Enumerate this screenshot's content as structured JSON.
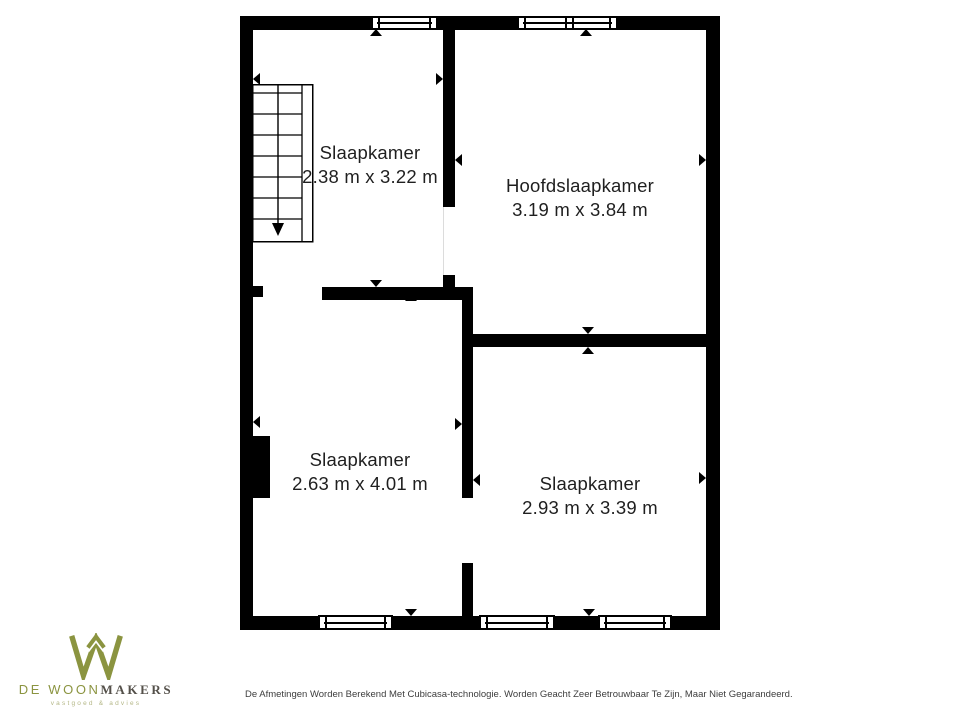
{
  "floorplan": {
    "wall_color": "#000000",
    "text_color": "#1F1F1F",
    "rooms": [
      {
        "name": "Slaapkamer",
        "dimensions": "2.38 m x 3.22 m"
      },
      {
        "name": "Hoofdslaapkamer",
        "dimensions": "3.19 m x 3.84 m"
      },
      {
        "name": "Slaapkamer",
        "dimensions": "2.63 m x 4.01 m"
      },
      {
        "name": "Slaapkamer",
        "dimensions": "2.93 m x 3.39 m"
      }
    ]
  },
  "branding": {
    "monogram": "W",
    "name_primary": "DE WOON",
    "name_secondary": "MAKERS",
    "tagline": "vastgoed & advies",
    "color_olive": "#8B9440",
    "color_dark": "#54504A",
    "color_tagline": "#B4B786"
  },
  "footer": {
    "disclaimer": "De Afmetingen Worden Berekend Met Cubicasa-technologie. Worden Geacht Zeer Betrouwbaar Te Zijn, Maar Niet Gegarandeerd."
  }
}
